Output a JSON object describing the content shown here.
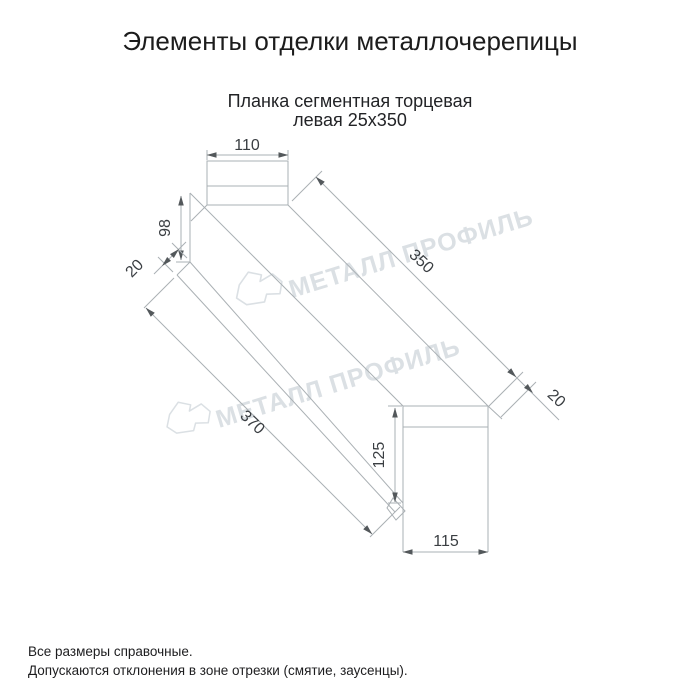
{
  "page": {
    "title": "Элементы отделки металлочерепицы",
    "subtitle_line1": "Планка сегментная торцевая",
    "subtitle_line2": "левая 25х350",
    "footer_line1": "Все размеры справочные.",
    "footer_line2": "Допускаются отклонения в зоне отрезки (смятие, заусенцы)."
  },
  "drawing": {
    "type": "technical-dimension-drawing",
    "part_name": "Планка сегментная торцевая левая 25х350",
    "dimensions": {
      "top_flange_width": "110",
      "left_end_height": "98",
      "left_lip": "20",
      "top_face_length": "350",
      "right_lip": "20",
      "bottom_face_length": "370",
      "right_end_height": "125",
      "bottom_flange_width": "115"
    },
    "watermark": {
      "text": "МЕТАЛЛ ПРОФИЛЬ"
    },
    "colors": {
      "background": "#ffffff",
      "outline_lines": "#aab0b4",
      "dimension_arrows": "#53585b",
      "dimension_text": "#3a3e42",
      "watermark": "#dbe0e4",
      "title_text": "#1c1c1c"
    }
  }
}
